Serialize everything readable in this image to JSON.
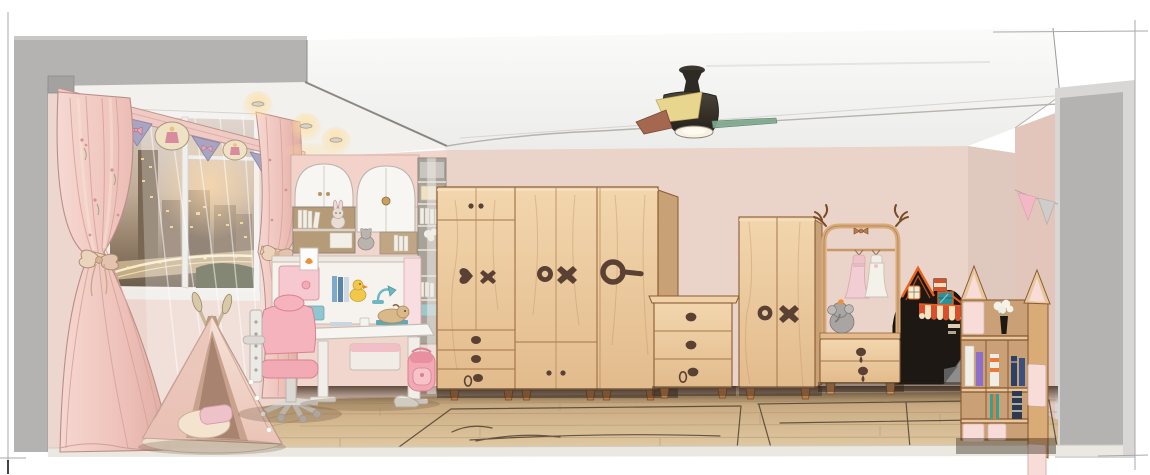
{
  "scene": {
    "type": "interior-illustration",
    "room": "kids-bedroom-elevation",
    "objects": [
      "drawing-frame-marks",
      "left-section-wall",
      "ceiling",
      "ceiling-soffit-downlights",
      "back-wall",
      "right-section-wall",
      "window-city-view",
      "valance",
      "curtain-left",
      "curtain-right",
      "sheer-curtain",
      "teepee-tent",
      "wall-cabinet-arched",
      "shelf-column",
      "desk-hutch",
      "study-desk",
      "desk-chair",
      "backpack",
      "wardrobe-large",
      "drawer-chest",
      "wardrobe-small",
      "clothes-rack",
      "hanging-dresses",
      "elephant-plush",
      "play-house-black",
      "house-bookshelf",
      "flower-vase",
      "bunting-flags",
      "ceiling-fan",
      "wood-floor",
      "rug-outlines"
    ]
  },
  "colors": {
    "wall_main": "#ead3c9",
    "wall_nook": "#f1d6cd",
    "wall_window": "#ecd6ce",
    "wall_right": "#e2c5bb",
    "wall_column": "#dfc8be",
    "ceiling": "#f7f6f4",
    "gray_wall": "#b4b3b2",
    "gray_light": "#d8d7d6",
    "floor_light": "#e0c9a4",
    "floor_mid": "#bda078",
    "baseboard": "#ebe8e1",
    "wood": "#ecc9a0",
    "wood_light": "#f4dcba",
    "wood_dark": "#d0a878",
    "wood_line": "#8a5a33",
    "handle": "#5a4134",
    "pink_furniture": "#f6c9d0",
    "pink_soft": "#f8dde1",
    "white_furniture": "#f4f2ee",
    "teal": "#6fb7c0",
    "curtain": "#f0cac5",
    "curtain_shade": "#dda89f",
    "lavender": "#a8a4c2",
    "cream": "#efe2c4",
    "city_glow": "#ffcf8e",
    "house_black": "#1d1814",
    "house_orange": "#e8601c",
    "awning_red": "#d94f2b",
    "book_purple": "#8b6fc9",
    "book_navy": "#2c3f66",
    "book_teal": "#2fa39a",
    "fan_dark": "#3b362e",
    "fan_yellow": "#e9d68e",
    "fan_red": "#a4674f",
    "fan_teal": "#7fa98e",
    "flag_pink": "#f2b8c6",
    "flag_gray": "#cfcdc9"
  }
}
